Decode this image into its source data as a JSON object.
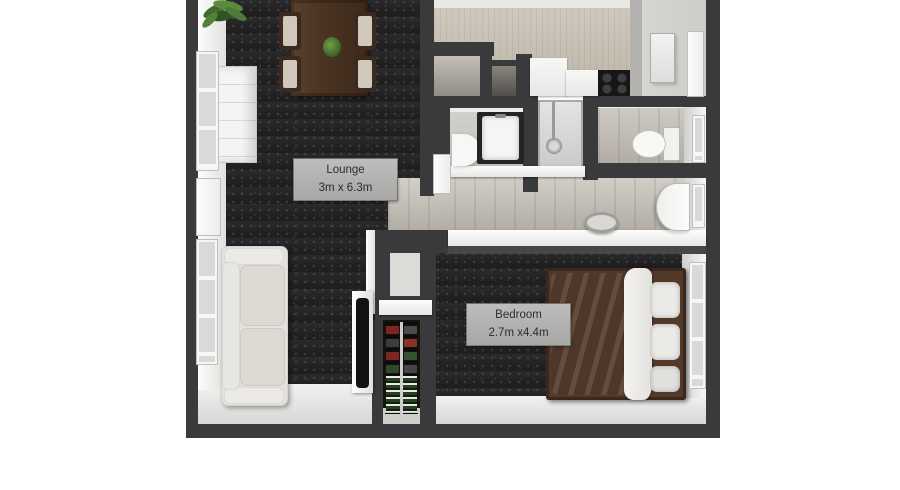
{
  "scene": {
    "type": "3D floor plan, top-down render of a one-bedroom apartment",
    "background_color": "#ffffff"
  },
  "labels": {
    "lounge": {
      "name": "Lounge",
      "dimensions": "3m x 6.3m"
    },
    "bedroom": {
      "name": "Bedroom",
      "dimensions": "2.7m x4.4m"
    }
  },
  "palette": {
    "wall": "#3a3a3c",
    "carpet": "#222224",
    "wood_floor": "#c0bab0",
    "light_floor": "#e6e6e5",
    "kitchen_wall": "#c6bfb1",
    "label_plate": "#b3b3b1",
    "label_text": "#2d2d2d",
    "sofa": "#e3e1dd",
    "bed_frame": "#53392a",
    "bed_duvet": "#99928b",
    "table_wood": "#4b3422",
    "plant_green": "#4e7a3a",
    "tv_screen": "#121214",
    "cooktop": "#161617",
    "rack_red": "#7c2622",
    "rack_green": "#375231"
  },
  "fixtures": [
    "corner-plant",
    "dining-table",
    "dining-chair",
    "table-plant",
    "tall-cabinet",
    "lounge-window-upper",
    "lounge-side-door",
    "lounge-window-lower",
    "sofa",
    "tv",
    "shoe-rack",
    "storage-closet",
    "storage-closet-small",
    "kitchen-counter",
    "cooktop",
    "entry-wall-panel",
    "entry-door",
    "bathroom-vanity",
    "bathroom-sink",
    "shower",
    "bathroom-door",
    "toilet",
    "wc-window",
    "hallway-stool",
    "hallway-door",
    "hallway-window",
    "double-bed",
    "bed-pillow",
    "bedroom-window"
  ]
}
